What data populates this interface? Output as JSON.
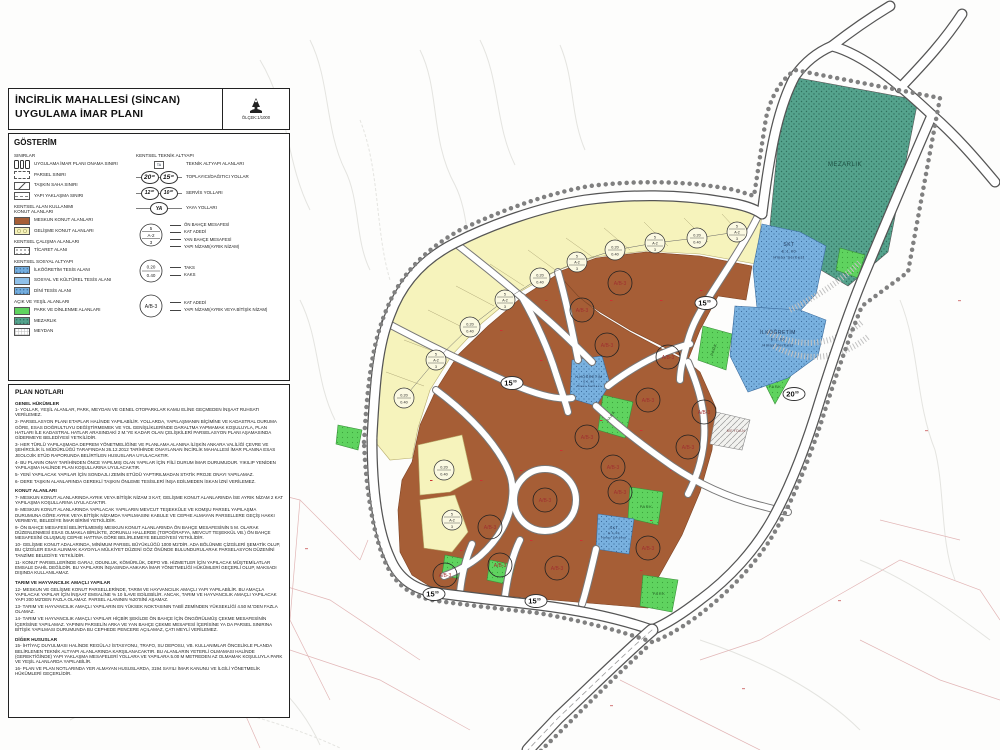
{
  "title_block": {
    "line1": "İNCİRLİK MAHALLESİ (SİNCAN)",
    "line2": "UYGULAMA İMAR PLANI",
    "scale": "ÖLÇEK:1/1000"
  },
  "legend": {
    "header": "GÖSTERİM",
    "left_groups": [
      {
        "title": "SINIRLAR",
        "items": [
          {
            "symbol": "onama",
            "label": "UYGULAMA İMAR PLANI ONAMA SINIRI"
          },
          {
            "symbol": "parcel",
            "label": "PARSEL SINIRI"
          },
          {
            "symbol": "flood",
            "label": "TAŞKIN SAHA SINIRI"
          },
          {
            "symbol": "setback",
            "label": "YAPI YAKLAŞMA SINIRI"
          }
        ]
      },
      {
        "title": "KENTSEL ALAN KULLANIMI\nKONUT ALANLARI",
        "items": [
          {
            "symbol": "meskun",
            "label": "MESKUN KONUT ALANLARI"
          },
          {
            "symbol": "gelisme",
            "label": "GELİŞME KONUT ALANLARI"
          }
        ]
      },
      {
        "title": "KENTSEL ÇALIŞMA ALANLARI",
        "items": [
          {
            "symbol": "ticaret",
            "label": "TİCARET ALANI"
          }
        ]
      },
      {
        "title": "KENTSEL SOSYAL ALTYAPI",
        "items": [
          {
            "symbol": "ilk",
            "label": "İLKÖĞRETİM TESİS ALANI"
          },
          {
            "symbol": "skt",
            "label": "SOSYAL VE KÜLTÜREL TESİS ALANI"
          },
          {
            "symbol": "dini",
            "label": "DİNİ TESİS ALANI"
          }
        ]
      },
      {
        "title": "AÇIK VE YEŞİL ALANLARI",
        "items": [
          {
            "symbol": "park",
            "label": "PARK VE DİNLENME ALANLARI"
          },
          {
            "symbol": "mezarlik",
            "label": "MEZARLIK"
          },
          {
            "symbol": "meydan",
            "label": "MEYDAN"
          }
        ]
      }
    ],
    "right_group": {
      "title": "KENTSEL TEKNİK ALTYAPI",
      "items": [
        {
          "symbol": "ta",
          "sym_text": "TA",
          "label": "TEKNİK ALTYAPI ALANLARI"
        },
        {
          "symbol": "road",
          "values": [
            "20",
            "15"
          ],
          "sup": "00",
          "big": true,
          "label": "TOPLAYICI/DAĞITICI YOLLAR"
        },
        {
          "symbol": "road",
          "values": [
            "12",
            "10"
          ],
          "sup": "00",
          "big": false,
          "label": "SERVİS YOLLARI"
        },
        {
          "symbol": "road",
          "values": [
            "YA"
          ],
          "sup": "",
          "big": false,
          "label": "YAYA YOLLARI"
        }
      ],
      "callouts": [
        {
          "circle": {
            "top": "5",
            "mid": "A-2",
            "bottom": "3"
          },
          "labels": [
            "ÖN BAHÇE MESAFESİ",
            "KAT ADEDİ",
            "YAN BAHÇE MESAFESİ",
            "YAPI NİZAMI(AYRIK NİZAM)"
          ]
        },
        {
          "circle": {
            "top": "0.20",
            "bottom": "0.40"
          },
          "labels": [
            "TAKS",
            "KAKS"
          ]
        },
        {
          "circle": {
            "mid": "A/B-3"
          },
          "labels": [
            "KAT ADEDİ",
            "YAPI NİZAMI(AYRIK VEYA BİTİŞİK NİZAM)"
          ]
        }
      ]
    }
  },
  "plan_notes": {
    "header": "PLAN NOTLARI",
    "sections": [
      {
        "title": "GENEL HÜKÜMLER",
        "items": [
          "1- YOLLAR, YEŞİL ALANLAR, PARK, MEYDAN VE GENEL OTOPARKLAR KAMU ELİNE GEÇMEDEN İNŞAAT RUHSATI VERİLEMEZ.",
          "2- PARSELASYON PLANI ETAPLAR HALİNDE YAPILABİLİR. YOLLARDA, YAPILAŞMANIN BİÇİMİNE VE KADASTRAL DURUMA GÖRE, ESAS DOĞRULTUYU DEĞİŞTİRMEMEK VE YOL GENİŞLİKLERİNDE DARALTMA YAPMAMAK KOŞULUYLA, PLAN HATLARI İLE KADASTRAL HATLAR ARASINDAKİ 2 M.'YE KADAR OLAN ÇELİŞKİLERİ PARSELASYON PLANI AŞAMASINDA GİDERMEYE BELEDİYESİ YETKİLİDİR.",
          "3- HER TÜRLÜ YAPILAŞMADA DEPREM YÖNETMELİĞİNE VE PLANLAMA ALANINA İLİŞKİN ANKARA VALİLİĞİ ÇEVRE VE ŞEHİRCİLİK İL MÜDÜRLÜĞÜ TARAFINDAN 26.12.2012 TARİHİNDE ONAYLANAN İNCİRLİK MAHALLESİ İMAR PLANINA ESAS JEOLOJİK ETÜD RAPORUNDA BELİRTİLEN HUSUSLARA UYULACAKTIR.",
          "4- BU PLANIN ONAY TARİHİNDEN ÖNCE YAPILMIŞ OLAN YAPILAR İÇİN FİİLİ DURUM İMAR DURUMUDUR. YIKILIP YENİDEN YAPILAŞMA HALİNDE PLAN KOŞULLARINA UYULACAKTIR.",
          "5- YENİ YAPILACAK YAPILAR İÇİN SONDAJLI ZEMİN ETÜDÜ YAPTIRILMADAN STATİK PROJE ONAYI YAPILAMAZ.",
          "6- DERE TAŞKIN ALANLARINDA GEREKLİ TAŞKIN ÖNLEME TESİSLERİ İNŞA EDİLMEDEN İSKAN İZNİ VERİLEMEZ."
        ]
      },
      {
        "title": "KONUT ALANLARI",
        "items": [
          "7- MESKUN KONUT ALANLARINDA AYRIK VEYA BİTİŞİK NİZAM 3 KAT, GELİŞME KONUT ALANLARINDA İSE AYRIK NİZAM 2 KAT YAPILAŞMA KOŞULLARINA UYULACAKTIR.",
          "8- MESKUN KONUT ALANLARINDA YAPILACAK YAPILARIN MEVCUT TEŞEKKÜLE VE KOMŞU PARSEL YAPILAŞMA DURUMUNA GÖRE AYRIK VEYA BİTİŞİK NİZAMDA YAPILMASINI KABULE VE CEPHE ALMAYAN PARSELLERE GEÇİŞ HAKKI VERMEYE, BELEDİYE İMAR BİRİMİ YETKİLİDİR.",
          "9- ÖN BAHÇE MESAFESİ BELİRTİLMEMİŞ MESKUN KONUT ALANLARINDA ÖN BAHÇE MESAFESİNİN 5 M. OLARAK DÜZENLENMESİ ESAS OLMAKLA BİRLİKTE, ZORUNLU HALLERDE (TOPOĞRAFYA, MEVCUT TEŞEKKÜL VB.) ÖN BAHÇE MESAFESİNİ OLUŞMUŞ CEPHE HATTINA GÖRE BELİRLEMEYE BELEDİYESİ YETKİLİDİR.",
          "10- GELİŞME KONUT ADALARINDA, MİNİMUM PARSEL BÜYÜKLÜĞÜ 1000 M2'DİR. ADA BÖLÜNME ÇİZGİLERİ ŞEMATİK OLUP, BU ÇİZGİLER ESAS ALINMAK KAYDIYLA MÜLKİYET DÜZENİ GÖZ ÖNÜNDE BULUNDURULARAK PARSELASYON DÜZENİNİ TANZİME BELEDİYE YETKİLİDİR.",
          "11- KONUT PARSELLERİNDE GARAJ, ODUNLUK, KÖMÜRLÜK, DEPO VB. HİZMETLER İÇİN YAPILACAK MÜŞTEMİLATLAR EMSALE DAHİL DEĞİLDİR. BU YAPILARIN İNŞASINDA ANKARA İMAR YÖNETMELİĞİ HÜKÜMLERİ GEÇERLİ OLUP, MAKSADI DIŞINDA KULLANILAMAZ."
        ]
      },
      {
        "title": "TARIM VE HAYVANCILIK AMAÇLI YAPILAR",
        "items": [
          "12- MESKUN VE GELİŞME KONUT PARSELLERİNDE, TARIM VE HAYVANCILIK AMAÇLI YAPI YAPILABİLİR. BU AMAÇLA YAPILACAK YAPILAR İÇİN İNŞAAT EMSALİNE % 10 İLAVE EDİLEBİLİR. ANCAK, TARIM VE HAYVANCILIK AMAÇLI YAPILACAK YAPI 200 M2'DEN FAZLA OLAMAZ. PARSEL ALANININ %20'SİNİ AŞAMAZ.",
          "13- TARIM VE HAYVANCILIK AMAÇLI YAPILARIN EN YÜKSEK NOKTASININ TABİİ ZEMİNDEN YÜKSEKLİĞİ 4.50 M.'DEN FAZLA OLAMAZ.",
          "14- TARIM VE HAYVANCILIK AMAÇLI YAPILAR HİÇBİR ŞEKİLDE ÖN BAHÇE İÇİN ÖNGÖRÜLMÜŞ ÇEKME MESAFESİNİN İÇERİSİNE YAPILAMAZ. YAPININ PARSELİN ARKA VE YAN BAHÇE ÇEKME MESAFESİ İÇERİSİNE YA DA PARSEL SINIRINA BİTİŞİK YAPILMASI DURUMUNDA BU CEPHEDE PENCERE AÇILAMAZ, ÇATI MEYLİ VERİLEMEZ."
        ]
      },
      {
        "title": "DİĞER HUSUSLAR",
        "items": [
          "15- İHTİYAÇ DUYULMASI HALİNDE REGÜLAJ İSTASYONU, TRAFO, SU DEPOSU, VB. KULLANIMLAR ÖNCELİKLE PLANDA BELİRLENEN TEKNİK ALTYAPI ALANLARINDA KARŞILANACAKTIR. BU ALANLARIN YETERLİ OLMAMASI HALİNDE (GEREKTİĞİNDE) YAPI YAKLAŞMA MESAFELERİ YOLLARA VE YAPILARA 5.00 M METREDEN AZ OLMAMAK KOŞULUYLA PARK VE YEŞİL ALANLARDA YAPILABİLİR.",
          "16- PLAN VE PLAN NOTLARINDA YER ALMAYAN HUSUSLARDA, 3194 SAYILI İMAR KANUNU VE İLGİLİ YÖNETMELİK HÜKÜMLERİ GEÇERLİDİR."
        ]
      }
    ]
  },
  "map": {
    "area_labels": [
      {
        "name": "mezarlik-label",
        "lines": [
          "MEZARLIK"
        ],
        "x": 845,
        "y": 166,
        "size": 6,
        "color": "#1d4f42"
      },
      {
        "name": "skt-north-label",
        "lines": [
          "SKT",
          "E:1.00",
          "Hmax Serbest"
        ],
        "x": 789,
        "y": 246,
        "size": 5,
        "color": "#223b5e"
      },
      {
        "name": "ilkogretim-east-label",
        "lines": [
          "İLKÖĞRETİM",
          "E:1.00",
          "Hmax Serbest"
        ],
        "x": 778,
        "y": 334,
        "size": 5,
        "color": "#223b5e"
      },
      {
        "name": "ilkogretim-center-label",
        "lines": [
          "İLKÖĞRETİM",
          "E:1.00",
          "Hmax Serbest"
        ],
        "x": 589,
        "y": 378,
        "size": 3.6,
        "color": "#223b5e"
      },
      {
        "name": "skt-south-label",
        "lines": [
          "SKT",
          "E:1.00",
          "Hmax Serbest"
        ],
        "x": 614,
        "y": 529,
        "size": 3.8,
        "color": "#223b5e"
      },
      {
        "name": "park-label",
        "lines": [
          "PARK"
        ],
        "x": 715,
        "y": 350,
        "size": 4,
        "color": "#235c23",
        "rotate": -72
      },
      {
        "name": "park-label",
        "lines": [
          "PARK"
        ],
        "x": 775,
        "y": 388,
        "size": 4,
        "color": "#235c23"
      },
      {
        "name": "park-label",
        "lines": [
          "PARK"
        ],
        "x": 612,
        "y": 417,
        "size": 4,
        "color": "#235c23",
        "rotate": -55
      },
      {
        "name": "park-label",
        "lines": [
          "PARK"
        ],
        "x": 646,
        "y": 508,
        "size": 4,
        "color": "#235c23"
      },
      {
        "name": "park-label",
        "lines": [
          "PARK"
        ],
        "x": 659,
        "y": 595,
        "size": 4,
        "color": "#235c23"
      },
      {
        "name": "meydan-label",
        "lines": [
          "MEYDAN"
        ],
        "x": 736,
        "y": 432,
        "size": 3.6,
        "color": "#8a4a4a"
      }
    ],
    "road_labels": [
      {
        "value": "15",
        "sup": "00",
        "x": 706,
        "y": 303
      },
      {
        "value": "15",
        "sup": "00",
        "x": 512,
        "y": 383
      },
      {
        "value": "15",
        "sup": "00",
        "x": 434,
        "y": 594
      },
      {
        "value": "15",
        "sup": "00",
        "x": 536,
        "y": 601
      },
      {
        "value": "20",
        "sup": "00",
        "x": 794,
        "y": 394
      }
    ],
    "block_labels": {
      "text": "A/B-3",
      "positions": [
        [
          582,
          310
        ],
        [
          620,
          283
        ],
        [
          607,
          345
        ],
        [
          668,
          357
        ],
        [
          648,
          400
        ],
        [
          704,
          412
        ],
        [
          587,
          437
        ],
        [
          688,
          447
        ],
        [
          613,
          467
        ],
        [
          545,
          500
        ],
        [
          620,
          492
        ],
        [
          648,
          548
        ],
        [
          500,
          565
        ],
        [
          557,
          568
        ],
        [
          445,
          575
        ],
        [
          490,
          527
        ]
      ]
    },
    "development_labels": {
      "taks_kaks": {
        "top": "0.20",
        "bottom": "0.40"
      },
      "nizam": {
        "top": "5",
        "mid": "A-2",
        "bottom": "3"
      },
      "positions": [
        [
          404,
          398
        ],
        [
          436,
          360
        ],
        [
          470,
          327
        ],
        [
          505,
          300
        ],
        [
          540,
          278
        ],
        [
          577,
          262
        ],
        [
          615,
          250
        ],
        [
          655,
          243
        ],
        [
          697,
          238
        ],
        [
          737,
          232
        ],
        [
          444,
          470
        ],
        [
          452,
          520
        ]
      ]
    }
  }
}
